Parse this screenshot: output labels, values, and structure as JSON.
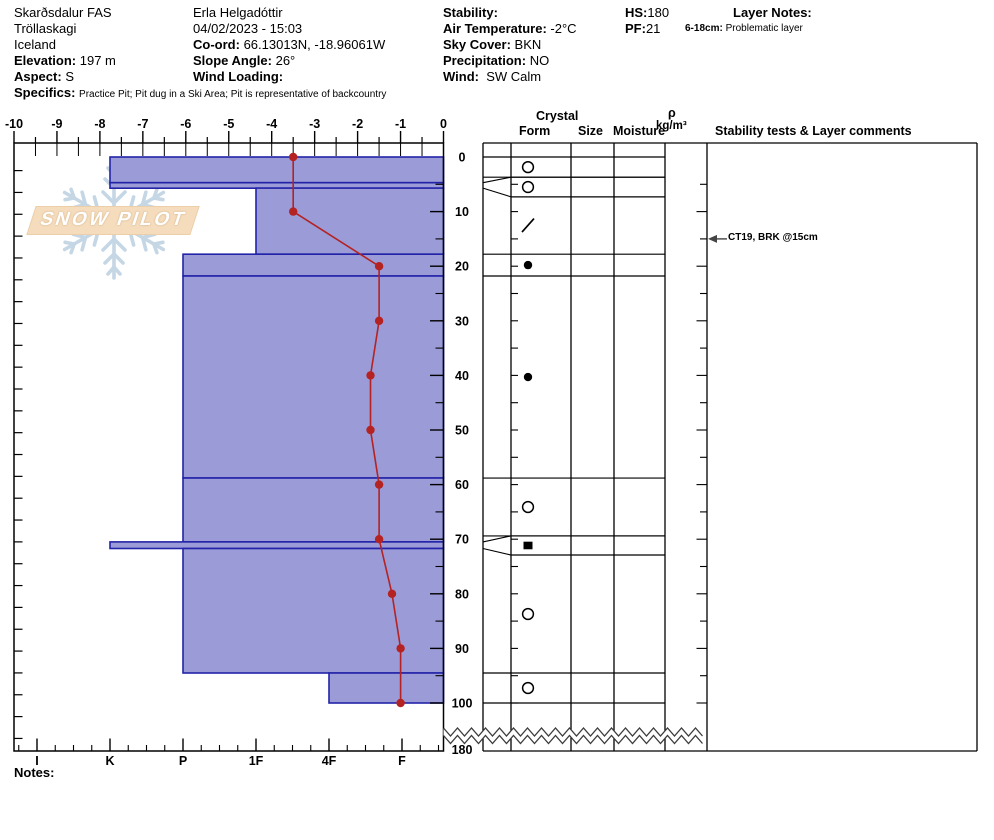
{
  "header": {
    "col1": {
      "site": "Skarðsdalur FAS",
      "region": "Tröllaskagi",
      "country": "Iceland",
      "elevation_label": "Elevation:",
      "elevation": "197 m",
      "aspect_label": "Aspect:",
      "aspect": "S",
      "specifics_label": "Specifics:",
      "specifics": "Practice Pit; Pit dug in a Ski Area; Pit is representative of backcountry"
    },
    "col2": {
      "observer": "Erla Helgadóttir",
      "datetime": "04/02/2023 - 15:03",
      "coord_label": "Co-ord:",
      "coord": "66.13013N, -18.96061W",
      "slope_label": "Slope Angle:",
      "slope": "26°",
      "wind_loading_label": "Wind Loading:",
      "wind_loading": ""
    },
    "col3": {
      "stability_label": "Stability:",
      "stability": "",
      "air_temp_label": "Air Temperature:",
      "air_temp": "-2°C",
      "sky_label": "Sky Cover:",
      "sky": "BKN",
      "precip_label": "Precipitation:",
      "precip": "NO",
      "wind_label": "Wind:",
      "wind": "SW Calm"
    },
    "col4": {
      "hs_label": "HS:",
      "hs": "180",
      "pf_label": "PF:",
      "pf": "21"
    },
    "col5": {
      "layer_notes_label": "Layer Notes:",
      "note_depth": "6-18cm:",
      "note_text": "Problematic layer"
    }
  },
  "watermark": {
    "badge": "SNOW PILOT"
  },
  "panel": {
    "crystal": "Crystal",
    "form": "Form",
    "size": "Size",
    "moisture": "Moisture",
    "rho": "ρ",
    "rho_units": "kg/m³",
    "stability_header": "Stability tests & Layer comments",
    "annotation": "CT19, BRK @15cm",
    "annotation_depth_cm": 15
  },
  "notes_label": "Notes:",
  "chart_data": {
    "type": "snow-profile (bar hardness + line temperature)",
    "title": "",
    "temperature_axis": {
      "unit": "°C",
      "min": -10,
      "max": 0,
      "tick_step": 1,
      "minor_step": 0.5
    },
    "hardness_axis": {
      "categories": [
        "I",
        "K",
        "P",
        "1F",
        "4F",
        "F"
      ]
    },
    "depth_axis": {
      "unit": "cm",
      "labels": [
        0,
        10,
        20,
        30,
        40,
        50,
        60,
        70,
        80,
        90,
        100
      ],
      "break_label": 180,
      "total_depth": 180
    },
    "temperature_profile": {
      "depth_cm": [
        0,
        10,
        20,
        30,
        40,
        50,
        60,
        70,
        80,
        90,
        100
      ],
      "temp_c": [
        -3.5,
        -3.5,
        -1.5,
        -1.5,
        -1.7,
        -1.7,
        -1.5,
        -1.5,
        -1.2,
        -1.0,
        -1.0
      ]
    },
    "layers": [
      {
        "top": 0,
        "bottom": 4.7,
        "hardness": "K",
        "grain_symbol": "circle-open",
        "flagged": false,
        "row_top": 0,
        "row_bottom": 3.7
      },
      {
        "top": 4.7,
        "bottom": 5.7,
        "hardness": "K",
        "grain_symbol": "circle-open",
        "flagged": true,
        "row_top": 3.7,
        "row_bottom": 7.3
      },
      {
        "top": 5.7,
        "bottom": 17.8,
        "hardness": "1F",
        "grain_symbol": "slash",
        "flagged": false,
        "row_top": 7.3,
        "row_bottom": 17.8
      },
      {
        "top": 17.8,
        "bottom": 21.8,
        "hardness": "P",
        "grain_symbol": "circle-filled",
        "flagged": false,
        "row_top": 17.8,
        "row_bottom": 21.8
      },
      {
        "top": 21.8,
        "bottom": 58.8,
        "hardness": "P",
        "grain_symbol": "circle-filled",
        "flagged": false,
        "row_top": 21.8,
        "row_bottom": 58.8
      },
      {
        "top": 58.8,
        "bottom": 70.5,
        "hardness": "P",
        "grain_symbol": "circle-open",
        "flagged": false,
        "row_top": 58.8,
        "row_bottom": 69.4
      },
      {
        "top": 70.5,
        "bottom": 71.7,
        "hardness": "K",
        "grain_symbol": "square-filled",
        "flagged": true,
        "row_top": 69.4,
        "row_bottom": 72.9
      },
      {
        "top": 71.7,
        "bottom": 94.5,
        "hardness": "P",
        "grain_symbol": "circle-open",
        "flagged": false,
        "row_top": 72.9,
        "row_bottom": 94.5
      },
      {
        "top": 94.5,
        "bottom": 100,
        "hardness": "4F",
        "grain_symbol": "circle-open",
        "flagged": false,
        "row_top": 94.5,
        "row_bottom": 100
      }
    ],
    "colors": {
      "bar_fill": "#9b9bd8",
      "bar_border": "#2323a8",
      "temp_line": "#b52222",
      "watermark_flake": "#bccfe1",
      "badge_fill": "#f5dcbd"
    }
  }
}
